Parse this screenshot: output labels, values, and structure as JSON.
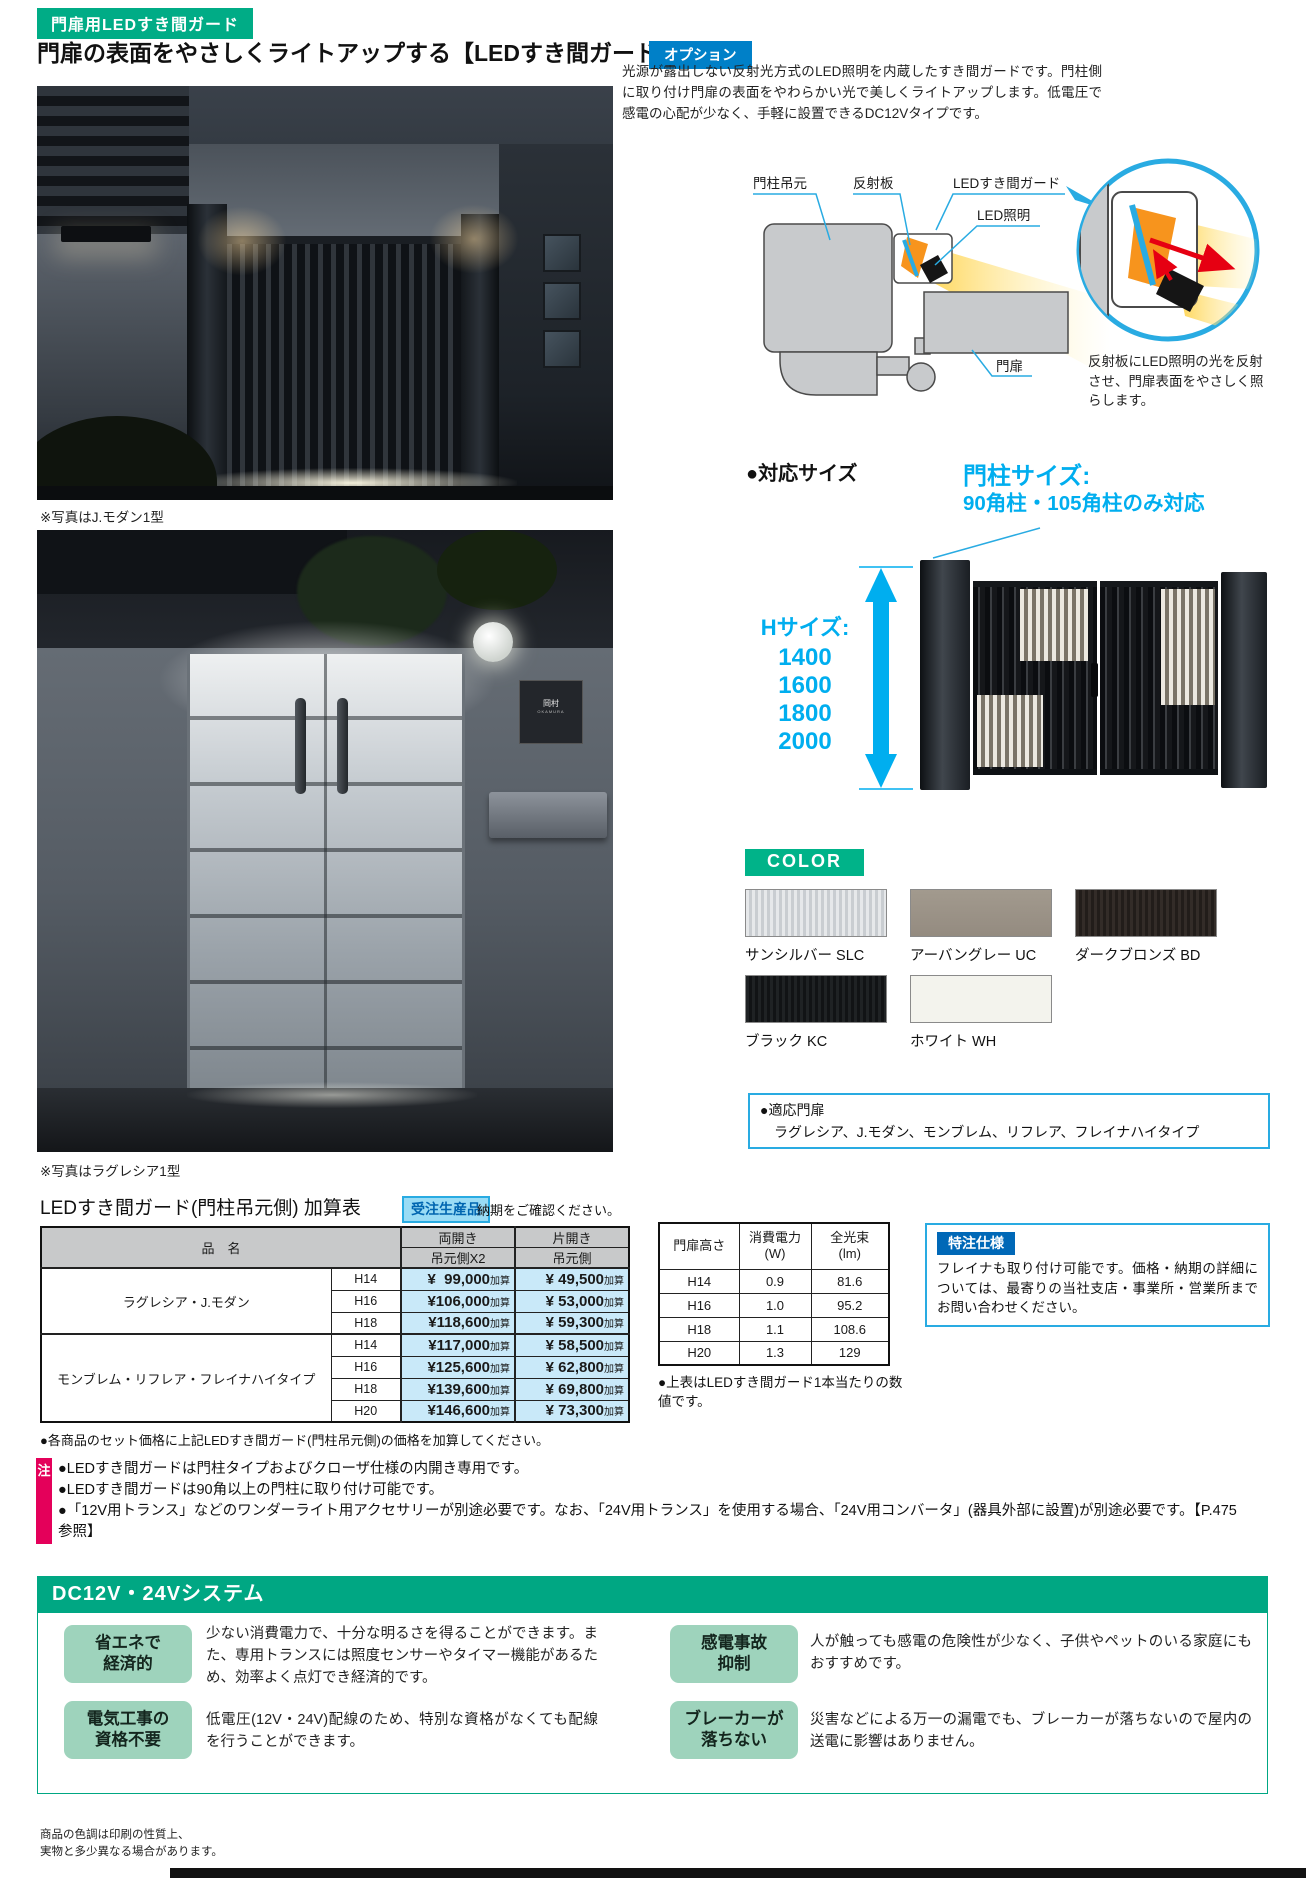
{
  "header": {
    "category_badge": "門扉用LEDすき間ガード",
    "title": "門扉の表面をやさしくライトアップする【LEDすき間ガード】",
    "option_badge": "オプション",
    "intro": "光源が露出しない反射光方式のLED照明を内蔵したすき間ガードです。門柱側に取り付け門扉の表面をやわらかい光で美しくライトアップします。低電圧で感電の心配が少なく、手軽に設置できるDC12Vタイプです。"
  },
  "photos": {
    "photo1_caption": "※写真はJ.モダン1型",
    "photo2_caption": "※写真はラグレシア1型",
    "nameplate_line1": "岡村",
    "nameplate_line2": "OKAMURA"
  },
  "diagram": {
    "label_post": "門柱吊元",
    "label_reflector": "反射板",
    "label_guard": "LEDすき間ガード",
    "label_led": "LED照明",
    "label_door": "門扉",
    "caption": "反射板にLED照明の光を反射させ、門扉表面をやさしく照らします。"
  },
  "sizes": {
    "heading": "●対応サイズ",
    "post_size_line1": "門柱サイズ:",
    "post_size_line2": "90角柱・105角柱のみ対応",
    "h_size_label": "Hサイズ:",
    "h_sizes": [
      "1400",
      "1600",
      "1800",
      "2000"
    ]
  },
  "colors": {
    "heading": "COLOR",
    "swatches": [
      {
        "label": "サンシルバー SLC",
        "hex": "#d8dbde"
      },
      {
        "label": "アーバングレー UC",
        "hex": "#9b9287"
      },
      {
        "label": "ダークブロンズ BD",
        "hex": "#2b2420"
      },
      {
        "label": "ブラック KC",
        "hex": "#17191b"
      },
      {
        "label": "ホワイト WH",
        "hex": "#f3f3ed"
      }
    ]
  },
  "applicable": {
    "heading": "●適応門扉",
    "list": "ラグレシア、J.モダン、モンブレム、リフレア、フレイナハイタイプ"
  },
  "price_table": {
    "title": "LEDすき間ガード(門柱吊元側) 加算表",
    "order_badge": "受注生産品",
    "order_note": "納期をご確認ください。",
    "col_product": "品　名",
    "col_double": "両開き",
    "col_double_sub": "吊元側X2",
    "col_single": "片開き",
    "col_single_sub": "吊元側",
    "suffix": "加算",
    "groups": [
      {
        "name": "ラグレシア・J.モダン",
        "rows": [
          {
            "h": "H14",
            "double": "¥  99,000",
            "single": "¥ 49,500"
          },
          {
            "h": "H16",
            "double": "¥106,000",
            "single": "¥ 53,000"
          },
          {
            "h": "H18",
            "double": "¥118,600",
            "single": "¥ 59,300"
          }
        ]
      },
      {
        "name": "モンブレム・リフレア・フレイナハイタイプ",
        "rows": [
          {
            "h": "H14",
            "double": "¥117,000",
            "single": "¥ 58,500"
          },
          {
            "h": "H16",
            "double": "¥125,600",
            "single": "¥ 62,800"
          },
          {
            "h": "H18",
            "double": "¥139,600",
            "single": "¥ 69,800"
          },
          {
            "h": "H20",
            "double": "¥146,600",
            "single": "¥ 73,300"
          }
        ]
      }
    ],
    "note": "●各商品のセット価格に上記LEDすき間ガード(門柱吊元側)の価格を加算してください。"
  },
  "spec_table": {
    "col_height": "門扉高さ",
    "col_power_l1": "消費電力",
    "col_power_l2": "(W)",
    "col_flux_l1": "全光束",
    "col_flux_l2": "(lm)",
    "rows": [
      {
        "h": "H14",
        "w": "0.9",
        "lm": "81.6"
      },
      {
        "h": "H16",
        "w": "1.0",
        "lm": "95.2"
      },
      {
        "h": "H18",
        "w": "1.1",
        "lm": "108.6"
      },
      {
        "h": "H20",
        "w": "1.3",
        "lm": "129"
      }
    ],
    "note": "●上表はLEDすき間ガード1本当たりの数値です。"
  },
  "custom_spec": {
    "badge": "特注仕様",
    "text": "フレイナも取り付け可能です。価格・納期の詳細については、最寄りの当社支店・事業所・営業所までお問い合わせください。"
  },
  "notes": {
    "badge": "注",
    "items": [
      "●LEDすき間ガードは門柱タイプおよびクローザ仕様の内開き専用です。",
      "●LEDすき間ガードは90角以上の門柱に取り付け可能です。",
      "●「12V用トランス」などのワンダーライト用アクセサリーが別途必要です。なお、「24V用トランス」を使用する場合、「24V用コンバータ」(器具外部に設置)が別途必要です。【P.475参照】"
    ]
  },
  "dc_system": {
    "title": "DC12V・24Vシステム",
    "features": [
      {
        "badge_l1": "省エネで",
        "badge_l2": "経済的",
        "text": "少ない消費電力で、十分な明るさを得ることができます。また、専用トランスには照度センサーやタイマー機能があるため、効率よく点灯でき経済的です。"
      },
      {
        "badge_l1": "感電事故",
        "badge_l2": "抑制",
        "text": "人が触っても感電の危険性が少なく、子供やペットのいる家庭にもおすすめです。"
      },
      {
        "badge_l1": "電気工事の",
        "badge_l2": "資格不要",
        "text": "低電圧(12V・24V)配線のため、特別な資格がなくても配線を行うことができます。"
      },
      {
        "badge_l1": "ブレーカーが",
        "badge_l2": "落ちない",
        "text": "災害などによる万一の漏電でも、ブレーカーが落ちないので屋内の送電に影響はありません。"
      }
    ]
  },
  "footer": {
    "line1": "商品の色調は印刷の性質上、",
    "line2": "実物と多少異なる場合があります。"
  },
  "theme": {
    "green": "#00AC86",
    "blue": "#0080C8",
    "cyan_accent": "#00AEEF",
    "cyan_border": "#29ABE2",
    "pink": "#E4005A",
    "table_header_bg": "#C8C9CA",
    "price_cell_bg": "#C9E9F9",
    "feature_badge_bg": "#9ED3BC",
    "beam_yellow": "#FFD34D",
    "arrow_red": "#E60012"
  }
}
